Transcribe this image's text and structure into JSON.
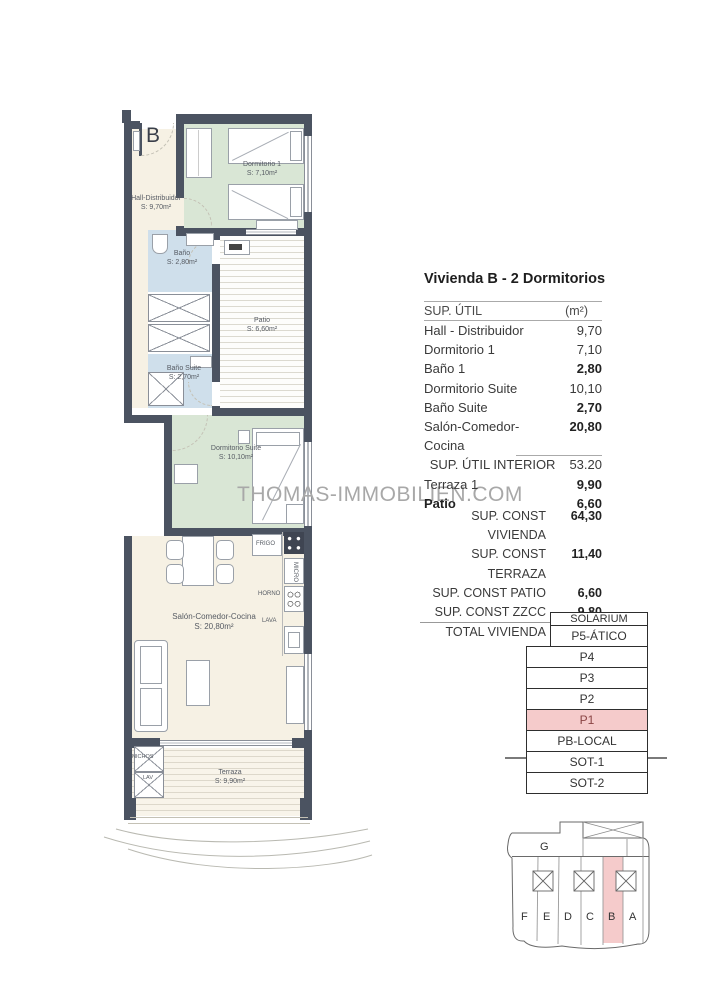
{
  "unit_label": "B",
  "watermark": "THOMAS-IMMOBILIEN.COM",
  "rooms": {
    "hall": {
      "name": "Hall-Distribuidor",
      "area": "S: 9,70m²"
    },
    "dorm1": {
      "name": "Dormitorio 1",
      "area": "S: 7,10m²"
    },
    "bath1": {
      "name": "Baño",
      "area": "S: 2,80m²"
    },
    "patio": {
      "name": "Patio",
      "area": "S: 6,60m²"
    },
    "bath_suite": {
      "name": "Baño Suite",
      "area": "S: 2,70m²"
    },
    "dorm_suite": {
      "name": "Dormitorio Suite",
      "area": "S: 10,10m²"
    },
    "salon": {
      "name": "Salón-Comedor-Cocina",
      "area": "S: 20,80m²"
    },
    "terraza": {
      "name": "Terraza",
      "area": "S: 9,90m²"
    }
  },
  "kitchen": {
    "frigo": "FRIGO",
    "micro": "MICRO",
    "horno": "HORNO",
    "lava": "LAVA"
  },
  "storage": {
    "top": "NICHOS",
    "bottom": "LAV"
  },
  "summary": {
    "title": "Vivienda B - 2 Dormitorios",
    "header": {
      "label": "SUP. ÚTIL",
      "unit": "(m²)"
    },
    "rows": [
      {
        "label": "Hall - Distribuidor",
        "value": "9,70"
      },
      {
        "label": "Dormitorio 1",
        "value": "7,10"
      },
      {
        "label": "Baño 1",
        "value": "2,80"
      },
      {
        "label": "Dormitorio Suite",
        "value": "10,10"
      },
      {
        "label": "Baño Suite",
        "value": "2,70"
      },
      {
        "label": "Salón-Comedor-Cocina",
        "value": "20,80"
      }
    ],
    "interior": {
      "label": "SUP. ÚTIL INTERIOR",
      "value": "53.20"
    },
    "ext": [
      {
        "label": "Terraza 1",
        "value": "9,90"
      },
      {
        "label": "Patio",
        "value": "6,60"
      }
    ],
    "const_rows": [
      {
        "label": "SUP. CONST VIVIENDA",
        "value": "64,30"
      },
      {
        "label": "SUP. CONST TERRAZA",
        "value": "11,40"
      },
      {
        "label": "SUP. CONST PATIO",
        "value": "6,60"
      },
      {
        "label": "SUP. CONST ZZCC",
        "value": "9,80"
      }
    ],
    "total": {
      "label": "TOTAL VIVIENDA",
      "value": "92.10"
    }
  },
  "floors": [
    "SOLARIUM",
    "P5-ÁTICO",
    "P4",
    "P3",
    "P2",
    "P1",
    "PB-LOCAL",
    "SOT-1",
    "SOT-2"
  ],
  "floors_highlighted": "P1",
  "site": {
    "g": "G",
    "units": [
      "F",
      "E",
      "D",
      "C",
      "B",
      "A"
    ],
    "highlighted_unit": "B"
  },
  "colors": {
    "wall": "#4b5361",
    "floor_cream": "#f6f1e4",
    "floor_green": "#d9e6d5",
    "floor_blue": "#cfdfeb",
    "highlight_pink": "#f5cbcb",
    "watermark": "#a8a8a8"
  }
}
